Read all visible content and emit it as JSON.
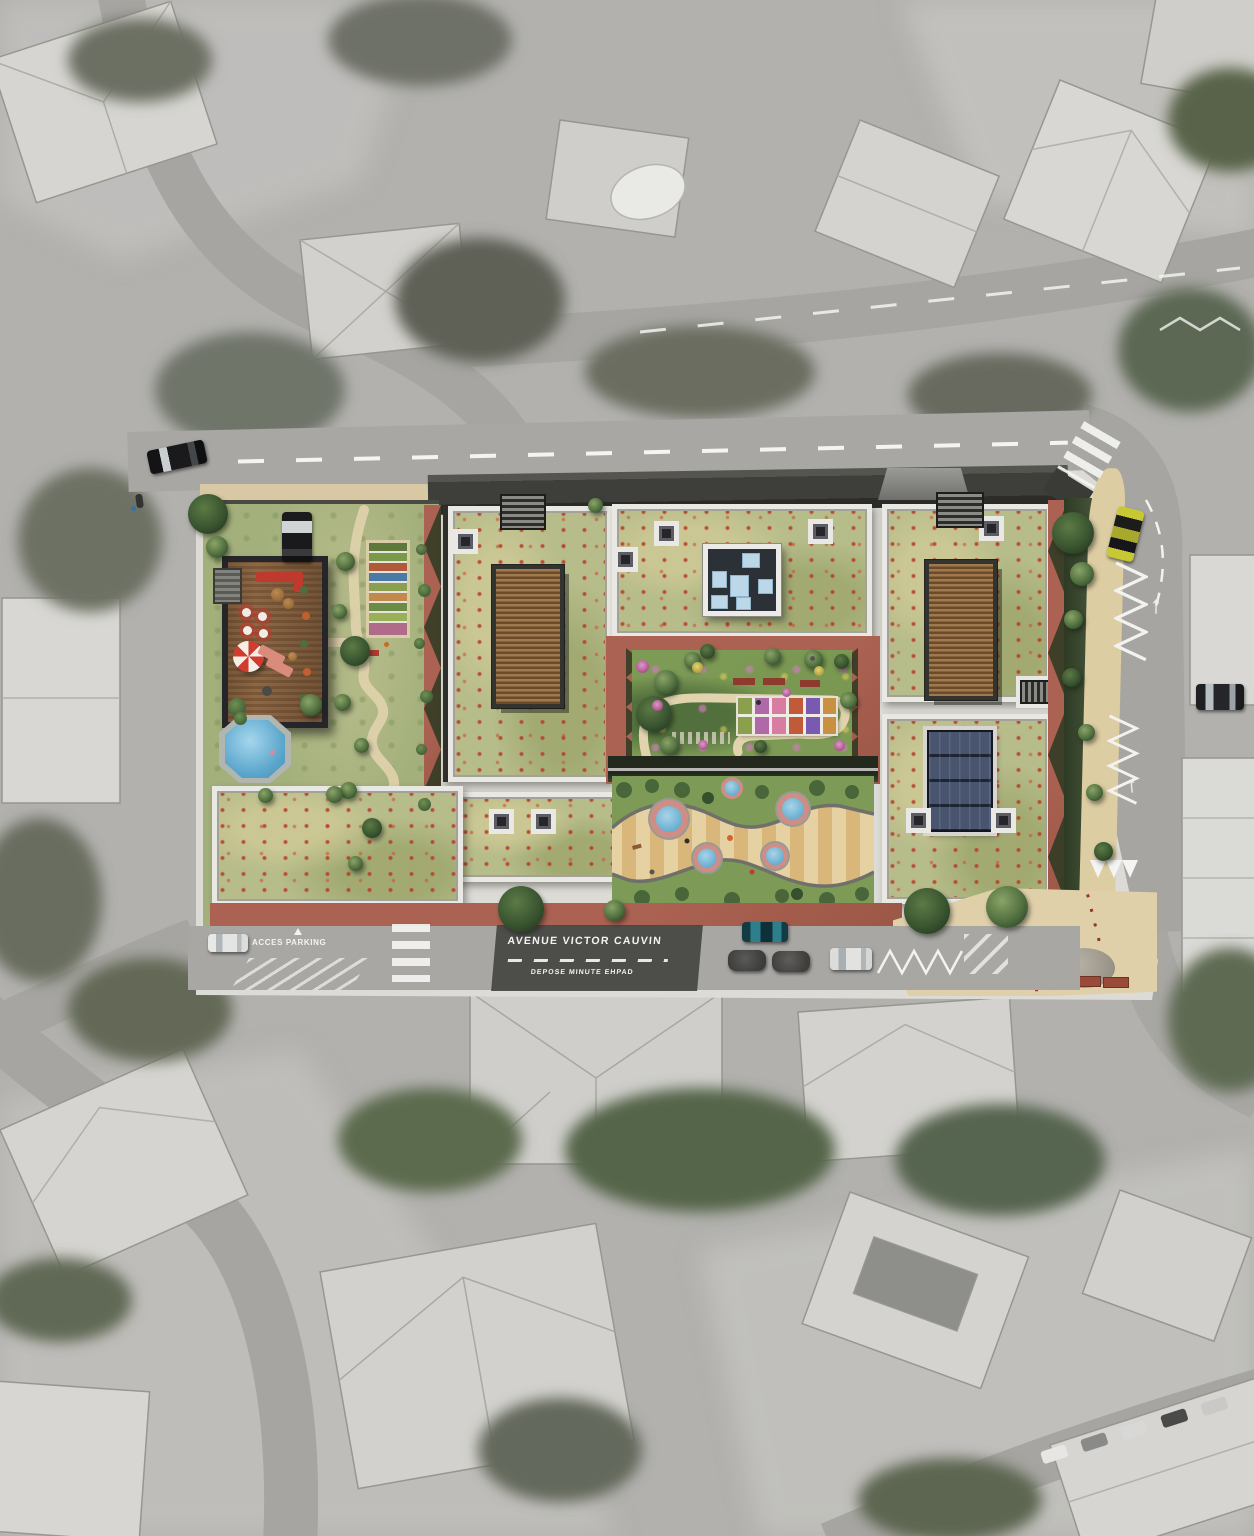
{
  "street_labels": {
    "avenue_name": "AVENUE VICTOR CAUVIN",
    "drop_off_zone": "DEPOSE MINUTE EHPAD",
    "parking_access": "ACCES PARKING"
  },
  "palette": {
    "aerial_gray": "#b3b2af",
    "road_gray": "#a8a7a3",
    "plate_gray": "#dcdbd6",
    "green_roof": "#b6bc8a",
    "poppy_red": "#ba3a26",
    "lawn_green": "#a3b07c",
    "garden_green": "#7e9b56",
    "terracotta": "#ab6252",
    "canopy_dark": "#3e3e3a",
    "path_beige": "#ddcfa8",
    "wood_deck": "#8d6845",
    "pergola_wood": "#8a6a42",
    "solar_panel": "#3d4660",
    "pool_blue": "#5ba6cc",
    "playground_sand": "#e6d1a2",
    "marking_white": "#f4f4f2",
    "taxi_yellow": "#c8c832",
    "teal_car": "#2e7f8c"
  },
  "features": [
    "aerial-photo-background",
    "wildflower-green-roof",
    "timber-pergola",
    "roof-skylight",
    "solar-panel-array",
    "roof-access-stair",
    "wood-deck-terrace",
    "parasol",
    "swimming-pool",
    "vegetable-garden",
    "winding-path",
    "sensory-garden",
    "raised-flower-beds",
    "playground",
    "splash-pool",
    "terracotta-terrace",
    "hedge-shadow",
    "pedestrian-plaza",
    "bollard-row",
    "crosswalk",
    "zigzag-marking",
    "lane-dashes",
    "parked-car",
    "street-tree"
  ]
}
